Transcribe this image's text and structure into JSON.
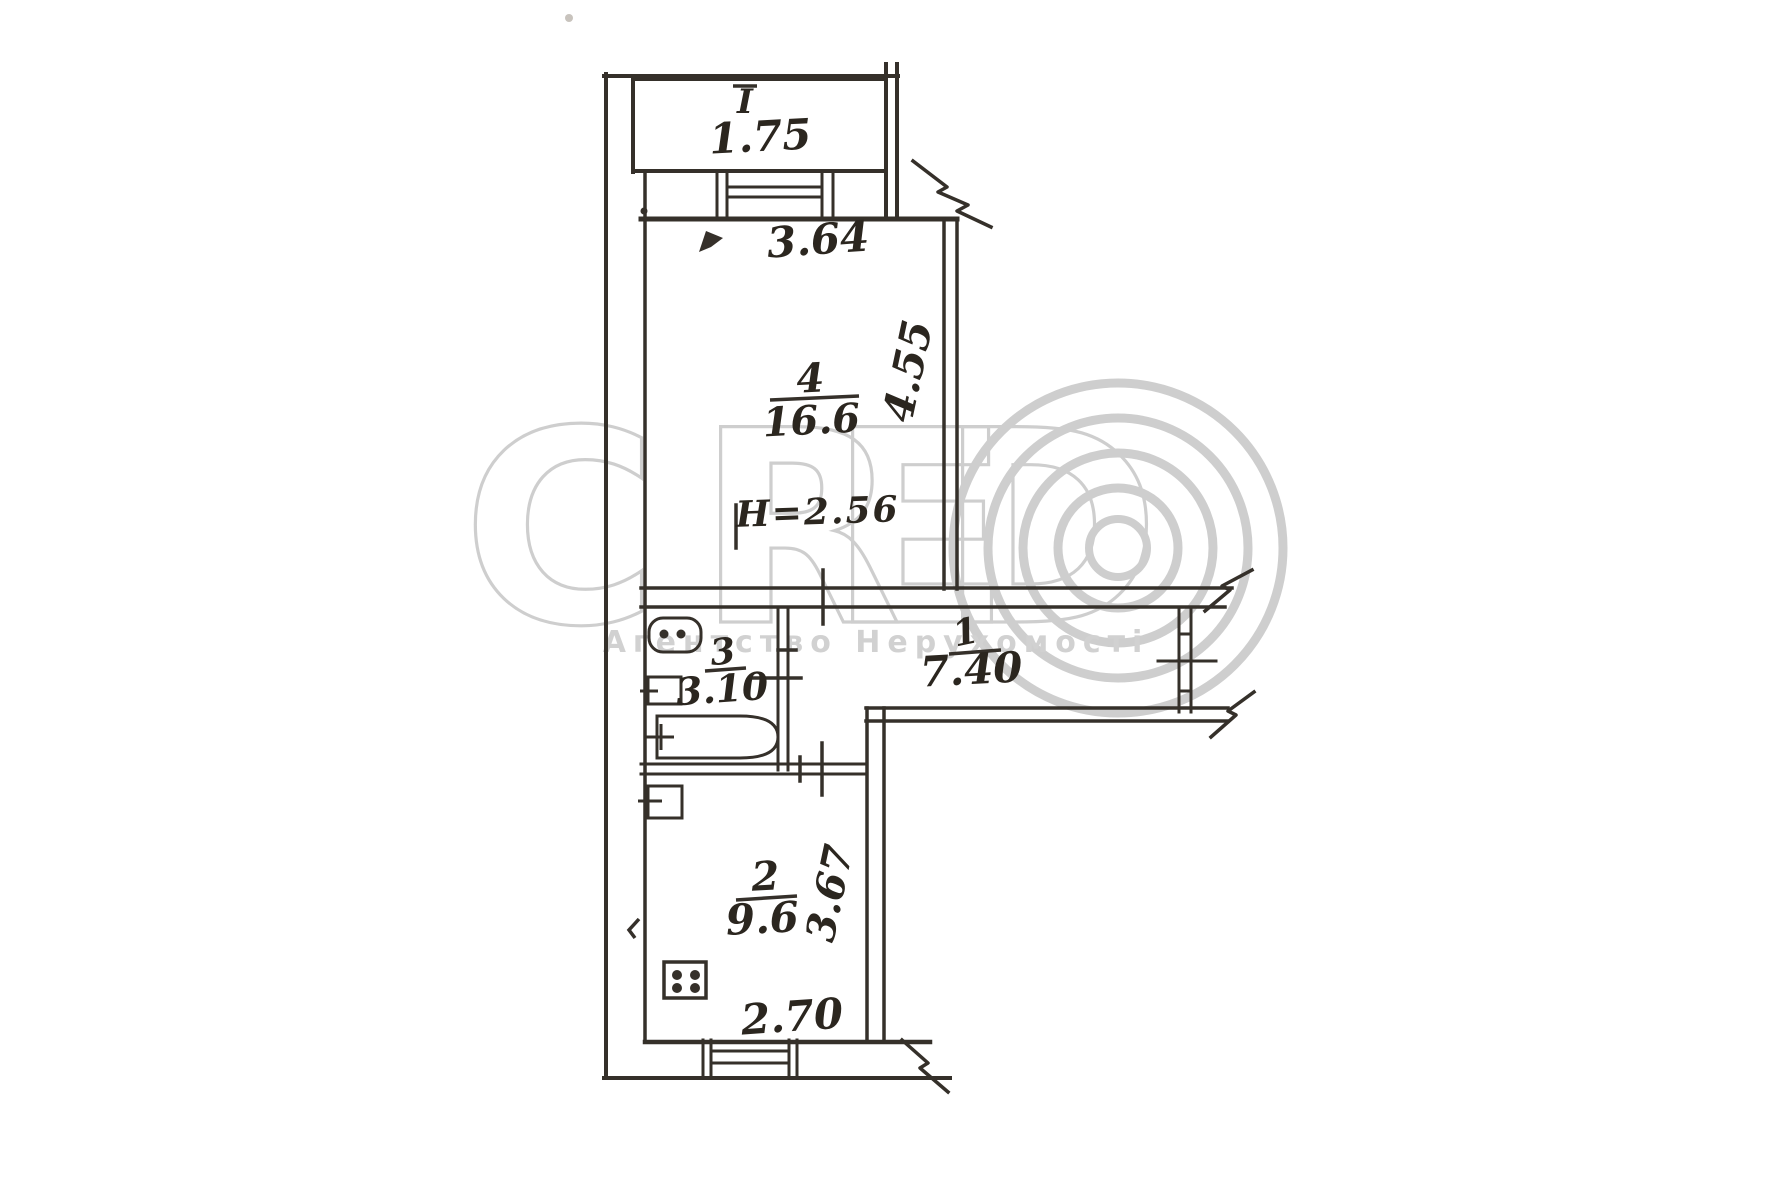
{
  "watermark": {
    "letters": [
      "C",
      "R",
      "E",
      "D"
    ],
    "subtitle": "Агентство Нерухомості"
  },
  "balcony": {
    "number": "I",
    "area": "1.75"
  },
  "rooms": {
    "living": {
      "number": "4",
      "area": "16.6"
    },
    "bath": {
      "number": "3",
      "area": "3.10"
    },
    "hall": {
      "number": "1",
      "area": "7.40"
    },
    "kitchen": {
      "number": "2",
      "area": "9.6"
    }
  },
  "dimensions": {
    "living_width": "3.64",
    "living_depth": "4.55",
    "ceiling_height": "H=2.56",
    "kitchen_depth": "3.67",
    "kitchen_width": "2.70"
  },
  "colors": {
    "ink": "#35302a",
    "watermark": "#c9c9c9",
    "paper": "#ffffff"
  }
}
